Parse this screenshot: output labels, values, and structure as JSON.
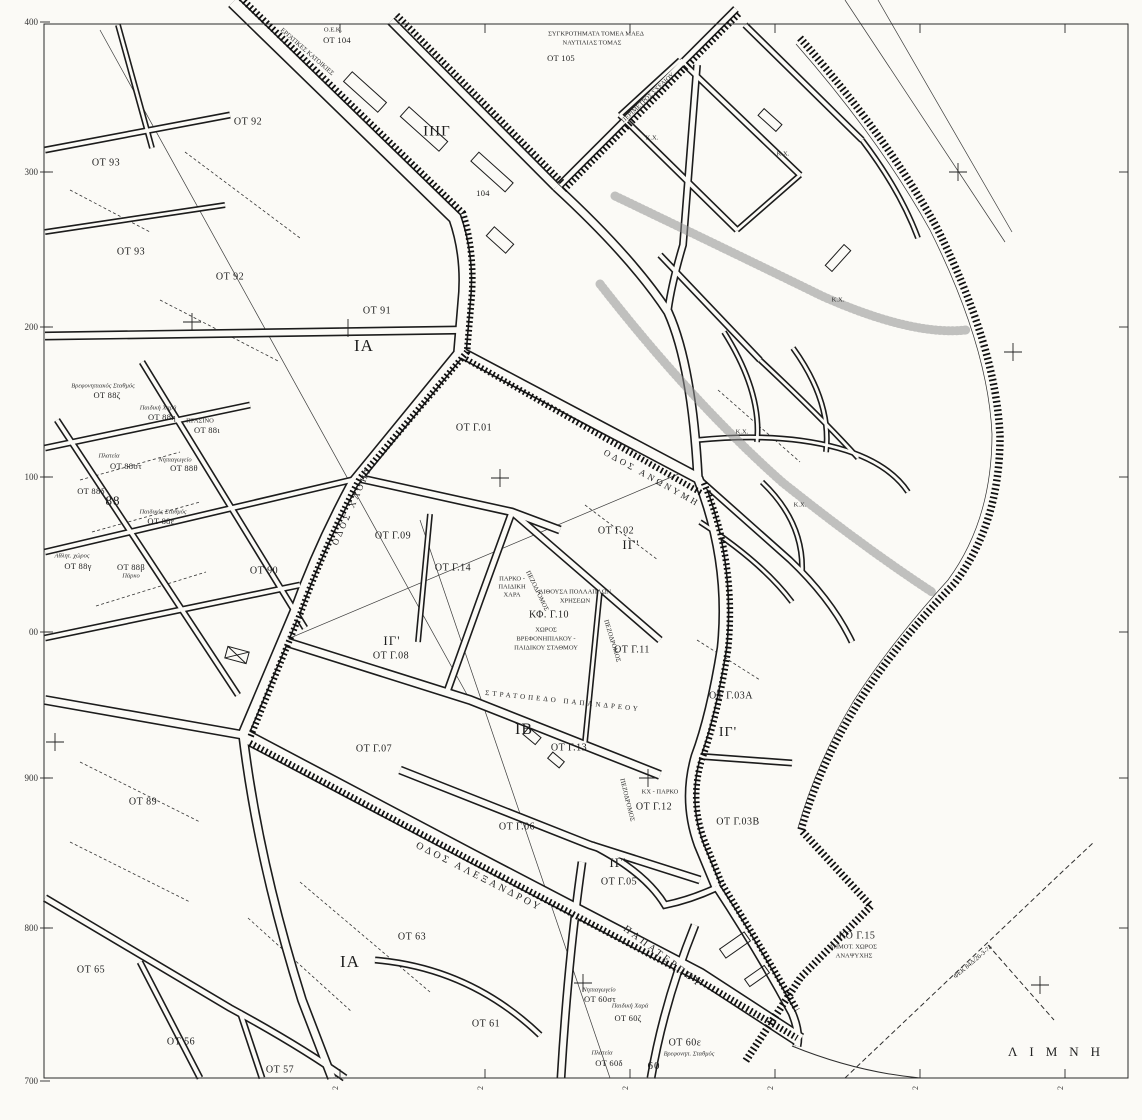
{
  "map": {
    "title_note_line1": "ΣΥΓΚΡΟΤΗΜΑΤΑ ΤΟΜΕΑ ΜΑΕΔ",
    "title_note_line2": "ΝΑΥΤΙΛΙΑΣ ΤΟΜΑΣ",
    "lake_label": "ΛΙΜΝΗ",
    "ink_color": "#1c1c1c",
    "paper_color": "#fbfaf6",
    "labels": [
      {
        "t": "Ο.Ε.Κ.",
        "x": 333,
        "y": 30,
        "c": "tiny"
      },
      {
        "t": "ΟΤ 104",
        "x": 337,
        "y": 40,
        "c": "blk8"
      },
      {
        "t": "ΕΡΓΑΤΙΚΕΣ ΚΑΤΟΙΚΙΕΣ",
        "x": 307,
        "y": 52,
        "c": "tiny",
        "r": 41
      },
      {
        "t": "ΙΙΙΓ",
        "x": 437,
        "y": 132,
        "c": "dst"
      },
      {
        "t": "104",
        "x": 483,
        "y": 193,
        "c": "blk8"
      },
      {
        "t": "ΣΥΓΚΡΟΤΗΜΑΤΑ ΤΟΜΕΑ ΜΑΕΔ",
        "x": 596,
        "y": 34,
        "c": "tiny"
      },
      {
        "t": "ΝΑΥΤΙΛΙΑΣ ΤΟΜΑΣ",
        "x": 592,
        "y": 43,
        "c": "tiny"
      },
      {
        "t": "ΟΤ 105",
        "x": 561,
        "y": 58,
        "c": "blk8"
      },
      {
        "t": "ΠΕΡΙΜΕΤΡΟΣ ΣΧΕΔΙΟΥ",
        "x": 648,
        "y": 98,
        "c": "tiny",
        "r": -43
      },
      {
        "t": "ΟΤ 92",
        "x": 248,
        "y": 122,
        "c": "blk"
      },
      {
        "t": "ΟΤ 92",
        "x": 230,
        "y": 277,
        "c": "blk"
      },
      {
        "t": "ΟΤ 93",
        "x": 106,
        "y": 163,
        "c": "blk"
      },
      {
        "t": "ΟΤ 93",
        "x": 131,
        "y": 252,
        "c": "blk"
      },
      {
        "t": "ΟΤ 91",
        "x": 377,
        "y": 311,
        "c": "blk"
      },
      {
        "t": "ΙΑ",
        "x": 364,
        "y": 346,
        "c": "dst",
        "s": 17
      },
      {
        "t": "ΟΤ 90",
        "x": 264,
        "y": 571,
        "c": "blk"
      },
      {
        "t": "ΟΤ 89",
        "x": 143,
        "y": 802,
        "c": "blk"
      },
      {
        "t": "Βρεφονηπιακός Σταθμός",
        "x": 103,
        "y": 386,
        "c": "tinyi"
      },
      {
        "t": "ΟΤ 88ζ",
        "x": 107,
        "y": 395,
        "c": "blk8"
      },
      {
        "t": "Παιδική Χαρά",
        "x": 158,
        "y": 408,
        "c": "tinyi"
      },
      {
        "t": "ΟΤ 88η",
        "x": 162,
        "y": 417,
        "c": "blk8"
      },
      {
        "t": "ΠΡΑΣΙΝΟ",
        "x": 200,
        "y": 421,
        "c": "tiny"
      },
      {
        "t": "ΟΤ 88ι",
        "x": 207,
        "y": 430,
        "c": "blk8"
      },
      {
        "t": "Πλατεία",
        "x": 109,
        "y": 456,
        "c": "tinyi"
      },
      {
        "t": "ΟΤ 88στ",
        "x": 126,
        "y": 466,
        "c": "blk8"
      },
      {
        "t": "Νηπιαγωγείο",
        "x": 175,
        "y": 460,
        "c": "tinyi"
      },
      {
        "t": "ΟΤ 88θ",
        "x": 184,
        "y": 468,
        "c": "blk8"
      },
      {
        "t": "ΟΤ 88δ",
        "x": 91,
        "y": 491,
        "c": "blk8"
      },
      {
        "t": "88",
        "x": 113,
        "y": 501,
        "c": "dst",
        "s": 13
      },
      {
        "t": "Παιδικός Σταθμός",
        "x": 163,
        "y": 512,
        "c": "tinyi"
      },
      {
        "t": "ΟΤ 88ε",
        "x": 161,
        "y": 521,
        "c": "blk8"
      },
      {
        "t": "Αθλητ. χώρος",
        "x": 72,
        "y": 556,
        "c": "tinyi"
      },
      {
        "t": "ΟΤ 88γ",
        "x": 78,
        "y": 566,
        "c": "blk8"
      },
      {
        "t": "ΟΤ 88β",
        "x": 131,
        "y": 567,
        "c": "blk8"
      },
      {
        "t": "Πάρκο",
        "x": 131,
        "y": 576,
        "c": "tinyi"
      },
      {
        "t": "ΟΔΟΣ ΧΛΟΗΣ",
        "x": 352,
        "y": 505,
        "c": "str",
        "r": -66
      },
      {
        "t": "ΟΤ Γ.09",
        "x": 393,
        "y": 536,
        "c": "blk"
      },
      {
        "t": "ΟΤ Γ.14",
        "x": 453,
        "y": 568,
        "c": "blk"
      },
      {
        "t": "ΟΤ Γ.01",
        "x": 474,
        "y": 428,
        "c": "blk"
      },
      {
        "t": "ΟΤ Γ.02",
        "x": 616,
        "y": 531,
        "c": "blk"
      },
      {
        "t": "ΙΓ'",
        "x": 631,
        "y": 545,
        "c": "dst",
        "s": 13
      },
      {
        "t": "ΟΔΟΣ ΑΝΩΝΥΜΗ",
        "x": 652,
        "y": 478,
        "c": "str",
        "r": 29
      },
      {
        "t": "ΠΑΡΚΟ -",
        "x": 512,
        "y": 579,
        "c": "tiny"
      },
      {
        "t": "ΠΑΙΔΙΚΗ",
        "x": 512,
        "y": 587,
        "c": "tiny"
      },
      {
        "t": "ΧΑΡΑ",
        "x": 512,
        "y": 595,
        "c": "tiny"
      },
      {
        "t": "ΑΙΘΟΥΣΑ ΠΟΛΛΑΠΛΩΝ",
        "x": 575,
        "y": 592,
        "c": "tiny"
      },
      {
        "t": "ΧΡΗΣΕΩΝ",
        "x": 575,
        "y": 601,
        "c": "tiny"
      },
      {
        "t": "ΚΦ. Γ.10",
        "x": 549,
        "y": 615,
        "c": "blk"
      },
      {
        "t": "ΧΩΡΟΣ",
        "x": 546,
        "y": 630,
        "c": "tiny"
      },
      {
        "t": "ΒΡΕΦΟΝΗΠΙΑΚΟΥ -",
        "x": 546,
        "y": 639,
        "c": "tiny"
      },
      {
        "t": "ΠΑΙΔΙΚΟΥ ΣΤΑΘΜΟΥ",
        "x": 546,
        "y": 648,
        "c": "tiny"
      },
      {
        "t": "ΠΕΖΟΔΡΟΜΟΣ",
        "x": 537,
        "y": 591,
        "c": "tiny",
        "r": 64
      },
      {
        "t": "ΠΕΖΟΔΡΟΜΟΣ",
        "x": 612,
        "y": 641,
        "c": "tiny",
        "r": 73
      },
      {
        "t": "ΠΕΖΟΔΡΟΜΟΣ",
        "x": 627,
        "y": 800,
        "c": "tiny",
        "r": 76
      },
      {
        "t": "ΟΤ Γ.11",
        "x": 632,
        "y": 650,
        "c": "blk"
      },
      {
        "t": "ΙΓ'",
        "x": 392,
        "y": 641,
        "c": "dst",
        "s": 13
      },
      {
        "t": "ΟΤ Γ.08",
        "x": 391,
        "y": 656,
        "c": "blk"
      },
      {
        "t": "ΟΤ Γ.07",
        "x": 374,
        "y": 749,
        "c": "blk"
      },
      {
        "t": "ΣΤΡΑΤΟΠΕΔΟ ΠΑΠΑΝΔΡΕΟΥ",
        "x": 563,
        "y": 701,
        "c": "str",
        "r": 6,
        "s": 7
      },
      {
        "t": "ΙΒ",
        "x": 524,
        "y": 730,
        "c": "dst",
        "s": 16
      },
      {
        "t": "ΟΤ Γ.13",
        "x": 569,
        "y": 748,
        "c": "blk"
      },
      {
        "t": "ΟΤ Γ.06",
        "x": 517,
        "y": 827,
        "c": "blk"
      },
      {
        "t": "ΚΧ - ΠΑΡΚΟ",
        "x": 660,
        "y": 792,
        "c": "tiny"
      },
      {
        "t": "ΟΤ Γ.12",
        "x": 654,
        "y": 807,
        "c": "blk"
      },
      {
        "t": "ΙΓ'",
        "x": 728,
        "y": 733,
        "c": "dst",
        "s": 14
      },
      {
        "t": "ΟΤ Γ.03Α",
        "x": 731,
        "y": 696,
        "c": "blk"
      },
      {
        "t": "ΟΤ Γ.03Β",
        "x": 738,
        "y": 822,
        "c": "blk"
      },
      {
        "t": "ΙΓ'",
        "x": 618,
        "y": 863,
        "c": "dst",
        "s": 13
      },
      {
        "t": "ΟΤ Γ.05",
        "x": 619,
        "y": 882,
        "c": "blk"
      },
      {
        "t": "ΟΔΟΣ ΑΛΕΞΑΝΔΡΟΥ",
        "x": 479,
        "y": 877,
        "c": "str",
        "r": 27,
        "s": 10
      },
      {
        "t": "ΠΑΠΑΤΕΡΠΟΥ",
        "x": 663,
        "y": 957,
        "c": "str",
        "r": 37,
        "s": 10
      },
      {
        "t": "ΙΑ",
        "x": 350,
        "y": 962,
        "c": "dst",
        "s": 17
      },
      {
        "t": "ΟΤ 63",
        "x": 412,
        "y": 937,
        "c": "blk"
      },
      {
        "t": "ΟΤ 61",
        "x": 486,
        "y": 1024,
        "c": "blk"
      },
      {
        "t": "ΟΤ 65",
        "x": 91,
        "y": 970,
        "c": "blk"
      },
      {
        "t": "ΟΤ 56",
        "x": 181,
        "y": 1042,
        "c": "blk"
      },
      {
        "t": "ΟΤ 57",
        "x": 280,
        "y": 1070,
        "c": "blk"
      },
      {
        "t": "Νηπιαγωγείο",
        "x": 599,
        "y": 990,
        "c": "tinyi"
      },
      {
        "t": "ΟΤ 60στ",
        "x": 600,
        "y": 999,
        "c": "blk8"
      },
      {
        "t": "Παιδική Χαρά",
        "x": 630,
        "y": 1006,
        "c": "tinyi"
      },
      {
        "t": "ΟΤ 60ζ",
        "x": 628,
        "y": 1018,
        "c": "blk8"
      },
      {
        "t": "Πλατεία",
        "x": 602,
        "y": 1053,
        "c": "tinyi"
      },
      {
        "t": "ΟΤ 60δ",
        "x": 609,
        "y": 1063,
        "c": "blk8"
      },
      {
        "t": "ΟΤ 60ε",
        "x": 685,
        "y": 1043,
        "c": "blk"
      },
      {
        "t": "Βρεφονηπ. Σταθμός",
        "x": 689,
        "y": 1054,
        "c": "tinyi"
      },
      {
        "t": "60",
        "x": 654,
        "y": 1066,
        "c": "dst",
        "s": 11
      },
      {
        "t": "ΚΟ Γ.15",
        "x": 857,
        "y": 936,
        "c": "blk"
      },
      {
        "t": "ΔΗΜΟΤ. ΧΩΡΟΣ",
        "x": 853,
        "y": 947,
        "c": "tiny"
      },
      {
        "t": "ΑΝΑΨΥΧΗΣ",
        "x": 854,
        "y": 956,
        "c": "tiny"
      },
      {
        "t": "ΦΕΚ 84Δ/26-3-74",
        "x": 973,
        "y": 962,
        "c": "tiny",
        "r": -40
      },
      {
        "t": "ΛΙΜΝΗ",
        "x": 1060,
        "y": 1052,
        "c": "lake"
      },
      {
        "t": "Κ.Χ.",
        "x": 652,
        "y": 138,
        "c": "tiny"
      },
      {
        "t": "Κ.Χ.",
        "x": 783,
        "y": 154,
        "c": "tiny"
      },
      {
        "t": "Κ.Χ.",
        "x": 838,
        "y": 300,
        "c": "tiny"
      },
      {
        "t": "Κ.Χ.",
        "x": 742,
        "y": 432,
        "c": "tiny"
      },
      {
        "t": "Κ.Χ.",
        "x": 800,
        "y": 505,
        "c": "tiny"
      }
    ],
    "grid": {
      "xs": [
        340,
        485,
        630,
        775,
        920,
        1065
      ],
      "ys": [
        172,
        327,
        477,
        632,
        778,
        928
      ],
      "left_labels": [
        {
          "t": "400",
          "y": 22
        },
        {
          "t": "300",
          "y": 172
        },
        {
          "t": "200",
          "y": 327
        },
        {
          "t": "100",
          "y": 477
        },
        {
          "t": "00",
          "y": 632
        },
        {
          "t": "900",
          "y": 778
        },
        {
          "t": "800",
          "y": 928
        },
        {
          "t": "700",
          "y": 1081
        }
      ],
      "bottom_tick_label": "2",
      "crosses": [
        [
          192,
          322
        ],
        [
          348,
          328
        ],
        [
          500,
          478
        ],
        [
          55,
          742
        ],
        [
          648,
          778
        ],
        [
          583,
          983
        ],
        [
          1013,
          352
        ],
        [
          958,
          172
        ],
        [
          1040,
          985
        ]
      ]
    }
  }
}
